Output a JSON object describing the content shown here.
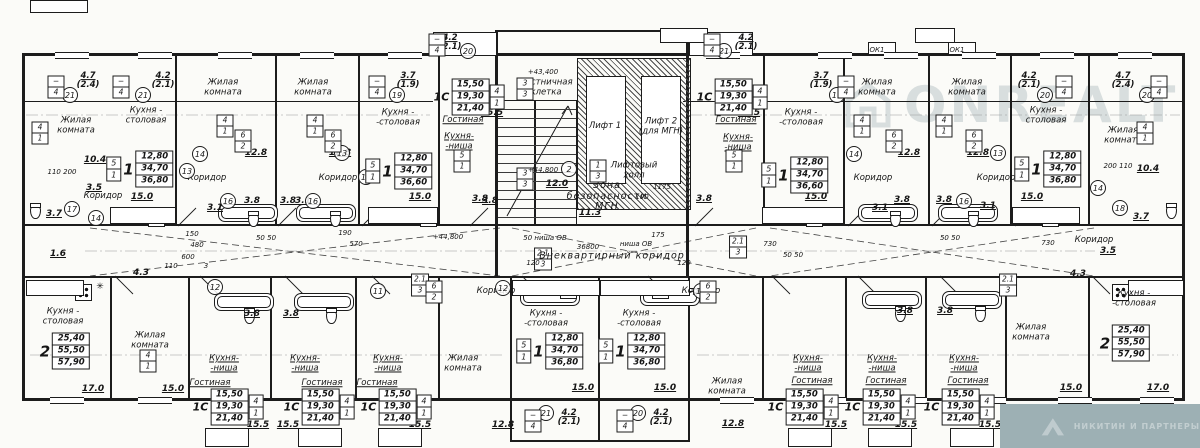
{
  "watermark": {
    "brand": "ONREALT",
    "agency": "НИКИТИН И ПАРТНЕРЫ"
  },
  "corridor": {
    "label": "Внеквартирный коридор",
    "length": "36800"
  },
  "core": {
    "stair": "Лестничная клетка",
    "stair_level": "+43,400",
    "landing_level": "+44,800",
    "lift1": "Лифт 1",
    "lift2": "Лифт 2 (для МГН)",
    "hall": "Лифтовый холл",
    "safety": "Зона безопасности МГН",
    "safety_area": "11.3",
    "landing_area": "12.0"
  },
  "labels": [
    [
      "Жилая\nкомната",
      76,
      126
    ],
    [
      "Кухня -\nстоловая",
      146,
      116
    ],
    [
      "Жилая\nкомната",
      223,
      88
    ],
    [
      "Жилая\nкомната",
      313,
      88
    ],
    [
      "Кухня -\n-столовая",
      398,
      118
    ],
    [
      "Гостиная",
      463,
      121,
      "u"
    ],
    [
      "Кухня-\n-ниша",
      459,
      142,
      "u"
    ],
    [
      "Лестничная\nклетка",
      546,
      88
    ],
    [
      "Лифт 1",
      605,
      127
    ],
    [
      "Лифт 2\n(для МГН)",
      661,
      127
    ],
    [
      "Лифтовый\nхолл",
      634,
      171
    ],
    [
      "Зона\nбезопасности\nМГН",
      607,
      197
    ],
    [
      "Гостиная",
      736,
      121,
      "u"
    ],
    [
      "Кухня-\n-ниша",
      738,
      143,
      "u"
    ],
    [
      "Кухня -\n-столовая",
      801,
      118
    ],
    [
      "Жилая\nкомната",
      877,
      88
    ],
    [
      "Жилая\nкомната",
      967,
      88
    ],
    [
      "Кухня -\nстоловая",
      1046,
      116
    ],
    [
      "Жилая\nкомната",
      1123,
      136
    ],
    [
      "Коридор",
      207,
      179
    ],
    [
      "Коридор",
      338,
      179
    ],
    [
      "Коридор",
      873,
      179
    ],
    [
      "Коридор",
      996,
      179
    ],
    [
      "Коридор",
      103,
      197
    ],
    [
      "Коридор",
      1094,
      241
    ],
    [
      "Кухня -\nстоловая",
      63,
      317
    ],
    [
      "Жилая\nкомната",
      150,
      341
    ],
    [
      "Кухня-\n-ниша",
      224,
      364,
      "u"
    ],
    [
      "Кухня-\n-ниша",
      305,
      364,
      "u"
    ],
    [
      "Кухня-\n-ниша",
      388,
      364,
      "u"
    ],
    [
      "Гостиная",
      210,
      384,
      "u"
    ],
    [
      "Гостиная",
      322,
      384,
      "u"
    ],
    [
      "Гостиная",
      377,
      384,
      "u"
    ],
    [
      "Жилая\nкомната",
      463,
      364
    ],
    [
      "Кухня -\n-столовая",
      546,
      319
    ],
    [
      "Кухня -\n-столовая",
      639,
      319
    ],
    [
      "Жилая\nкомната",
      727,
      387
    ],
    [
      "Кухня-\n-ниша",
      808,
      364,
      "u"
    ],
    [
      "Кухня-\n-ниша",
      882,
      364,
      "u"
    ],
    [
      "Кухня-\n-ниша",
      964,
      364,
      "u"
    ],
    [
      "Гостиная",
      812,
      382,
      "u"
    ],
    [
      "Гостиная",
      886,
      382,
      "u"
    ],
    [
      "Гостиная",
      968,
      382,
      "u"
    ],
    [
      "Жилая\nкомната",
      1031,
      333
    ],
    [
      "Кухня -\n-столовая",
      1134,
      299
    ],
    [
      "Коридор",
      496,
      292
    ],
    [
      "Коридор",
      701,
      292
    ]
  ],
  "areas": [
    [
      "10.4",
      95,
      160
    ],
    [
      "15.0",
      142,
      197
    ],
    [
      "12.8",
      256,
      153
    ],
    [
      "12.8",
      340,
      153
    ],
    [
      "15.0",
      420,
      197
    ],
    [
      "15.5",
      492,
      113
    ],
    [
      "3.8",
      480,
      199
    ],
    [
      "12.0",
      557,
      184
    ],
    [
      "11.3",
      590,
      213
    ],
    [
      "15.5",
      749,
      113
    ],
    [
      "3.8",
      704,
      199
    ],
    [
      "15.0",
      816,
      197
    ],
    [
      "12.8",
      909,
      153
    ],
    [
      "12.8",
      978,
      153
    ],
    [
      "15.0",
      1032,
      197
    ],
    [
      "10.4",
      1148,
      169
    ],
    [
      "3.7",
      1141,
      217
    ],
    [
      "3.7",
      54,
      214
    ],
    [
      "1.6",
      58,
      254
    ],
    [
      "3.5",
      94,
      188
    ],
    [
      "3.5",
      1108,
      251
    ],
    [
      "17.0",
      93,
      389
    ],
    [
      "15.0",
      173,
      389
    ],
    [
      "15.5",
      258,
      425
    ],
    [
      "15.5",
      288,
      425
    ],
    [
      "15.5",
      420,
      425
    ],
    [
      "12.8",
      503,
      425
    ],
    [
      "15.0",
      583,
      388
    ],
    [
      "15.0",
      665,
      388
    ],
    [
      "12.8",
      733,
      424
    ],
    [
      "15.5",
      836,
      425
    ],
    [
      "15.5",
      906,
      425
    ],
    [
      "15.5",
      990,
      425
    ],
    [
      "15.0",
      1071,
      388
    ],
    [
      "17.0",
      1158,
      388
    ],
    [
      "3.8",
      252,
      201
    ],
    [
      "3.8",
      288,
      201
    ],
    [
      "3.8",
      490,
      201
    ],
    [
      "3.8",
      902,
      200
    ],
    [
      "3.8",
      944,
      200
    ],
    [
      "3.8",
      252,
      314
    ],
    [
      "3.8",
      291,
      314
    ],
    [
      "3.8",
      905,
      311
    ],
    [
      "3.8",
      945,
      311
    ],
    [
      "3.1",
      215,
      208
    ],
    [
      "3.1",
      303,
      201
    ],
    [
      "3.1",
      880,
      208
    ],
    [
      "3.1",
      988,
      206
    ],
    [
      "4.3",
      141,
      273
    ],
    [
      "4.3",
      1078,
      274
    ]
  ],
  "balconies": [
    [
      "4.7",
      "(2.4)",
      88,
      81
    ],
    [
      "4.2",
      "(2.1)",
      163,
      81
    ],
    [
      "3.7",
      "(1.9)",
      408,
      81
    ],
    [
      "4.2",
      "(2.1)",
      450,
      43
    ],
    [
      "4.2",
      "(2.1)",
      746,
      43
    ],
    [
      "3.7",
      "(1.9)",
      821,
      81
    ],
    [
      "4.2",
      "(2.1)",
      1029,
      81
    ],
    [
      "4.7",
      "(2.4)",
      1123,
      81
    ],
    [
      "4.2",
      "(2.1)",
      569,
      418
    ],
    [
      "4.2",
      "(2.1)",
      661,
      418
    ]
  ],
  "circles": [
    [
      "21",
      70,
      95
    ],
    [
      "21",
      143,
      95
    ],
    [
      "19",
      397,
      95
    ],
    [
      "20",
      468,
      51
    ],
    [
      "21",
      724,
      51
    ],
    [
      "19",
      837,
      95
    ],
    [
      "20",
      1045,
      95
    ],
    [
      "20",
      1147,
      95
    ],
    [
      "17",
      72,
      209
    ],
    [
      "14",
      96,
      218
    ],
    [
      "13",
      187,
      171
    ],
    [
      "14",
      200,
      154
    ],
    [
      "16",
      228,
      201
    ],
    [
      "13",
      342,
      153
    ],
    [
      "14",
      366,
      177
    ],
    [
      "16",
      313,
      201
    ],
    [
      "2",
      569,
      169
    ],
    [
      "12",
      215,
      287
    ],
    [
      "12",
      503,
      288
    ],
    [
      "11",
      378,
      291
    ],
    [
      "11",
      701,
      291
    ],
    [
      "14",
      854,
      154
    ],
    [
      "13",
      998,
      153
    ],
    [
      "16",
      964,
      201
    ],
    [
      "14",
      1098,
      188
    ],
    [
      "18",
      1120,
      208
    ],
    [
      "21",
      546,
      413
    ],
    [
      "20",
      638,
      413
    ]
  ],
  "tags": [
    [
      "−",
      "4",
      56,
      87
    ],
    [
      "−",
      "4",
      121,
      87
    ],
    [
      "−",
      "4",
      377,
      87
    ],
    [
      "−",
      "4",
      437,
      45
    ],
    [
      "−",
      "4",
      712,
      45
    ],
    [
      "−",
      "4",
      846,
      87
    ],
    [
      "−",
      "4",
      1064,
      87
    ],
    [
      "−",
      "4",
      1159,
      87
    ],
    [
      "4",
      "1",
      40,
      133
    ],
    [
      "4",
      "1",
      225,
      126
    ],
    [
      "4",
      "1",
      315,
      126
    ],
    [
      "5",
      "1",
      462,
      161
    ],
    [
      "5",
      "1",
      734,
      161
    ],
    [
      "4",
      "1",
      862,
      126
    ],
    [
      "4",
      "1",
      944,
      126
    ],
    [
      "4",
      "1",
      1145,
      133
    ],
    [
      "6",
      "2",
      243,
      141
    ],
    [
      "6",
      "2",
      333,
      141
    ],
    [
      "6",
      "2",
      894,
      141
    ],
    [
      "6",
      "2",
      974,
      141
    ],
    [
      "3",
      "3",
      525,
      89
    ],
    [
      "3",
      "3",
      525,
      179
    ],
    [
      "1",
      "3",
      598,
      171
    ],
    [
      "2.1",
      "3",
      420,
      285
    ],
    [
      "2.1",
      "3",
      543,
      259
    ],
    [
      "2.1",
      "3",
      738,
      247
    ],
    [
      "2.1",
      "3",
      1008,
      285
    ],
    [
      "−",
      "4",
      533,
      421
    ],
    [
      "−",
      "4",
      625,
      421
    ],
    [
      "4",
      "1",
      148,
      361
    ],
    [
      "6",
      "2",
      434,
      292
    ],
    [
      "6",
      "2",
      708,
      292
    ]
  ],
  "stamps": [
    [
      "1",
      "12,80",
      "34,70",
      "36,80",
      140,
      169,
      1,
      0
    ],
    [
      "1",
      "12,80",
      "34,70",
      "36,60",
      399,
      171,
      1,
      0
    ],
    [
      "1С",
      "15,50",
      "19,30",
      "21,40",
      468,
      97,
      0,
      1
    ],
    [
      "1С",
      "15,50",
      "19,30",
      "21,40",
      731,
      97,
      0,
      1
    ],
    [
      "1",
      "12,80",
      "34,70",
      "36,60",
      795,
      175,
      1,
      0
    ],
    [
      "1",
      "12,80",
      "34,70",
      "36,80",
      1048,
      169,
      1,
      0
    ],
    [
      "2",
      "25,40",
      "55,50",
      "57,90",
      64,
      351,
      0,
      0
    ],
    [
      "2",
      "25,40",
      "55,50",
      "57,90",
      1124,
      343,
      0,
      0
    ],
    [
      "1С",
      "15,50",
      "19,30",
      "21,40",
      227,
      407,
      0,
      1
    ],
    [
      "1С",
      "15,50",
      "19,30",
      "21,40",
      318,
      407,
      0,
      1
    ],
    [
      "1С",
      "15,50",
      "19,30",
      "21,40",
      395,
      407,
      0,
      1
    ],
    [
      "1",
      "12,80",
      "34,70",
      "36,80",
      550,
      351,
      1,
      0
    ],
    [
      "1",
      "12,80",
      "34,70",
      "36,80",
      632,
      351,
      1,
      0
    ],
    [
      "1С",
      "15,50",
      "19,30",
      "21,40",
      802,
      407,
      0,
      1
    ],
    [
      "1С",
      "15,50",
      "19,30",
      "21,40",
      879,
      407,
      0,
      1
    ],
    [
      "1С",
      "15,50",
      "19,30",
      "21,40",
      958,
      407,
      0,
      1
    ]
  ],
  "dims": [
    [
      "110 200",
      62,
      172
    ],
    [
      "200 110",
      1118,
      166
    ],
    [
      "+43,400",
      543,
      72
    ],
    [
      "+44,800",
      543,
      170
    ],
    [
      "+44,800",
      448,
      237
    ],
    [
      "36800",
      588,
      247
    ],
    [
      "50 ниша ОВ",
      545,
      238
    ],
    [
      "ниша ОВ",
      636,
      244
    ],
    [
      "1175",
      662,
      187
    ],
    [
      "100",
      642,
      197
    ],
    [
      "175",
      658,
      235
    ],
    [
      "120",
      533,
      263
    ],
    [
      "120",
      684,
      263
    ],
    [
      "730",
      770,
      244
    ],
    [
      "730",
      1048,
      243
    ],
    [
      "570",
      356,
      244
    ],
    [
      "190",
      345,
      233
    ],
    [
      "480",
      197,
      245
    ],
    [
      "600",
      188,
      257
    ],
    [
      "110",
      171,
      266
    ],
    [
      "150",
      192,
      234
    ],
    [
      "50  50",
      266,
      238
    ],
    [
      "50  50",
      793,
      255
    ],
    [
      "50  50",
      950,
      238
    ],
    [
      "ОК1",
      877,
      50
    ],
    [
      "ОК1",
      957,
      50
    ],
    [
      "ОК2",
      1037,
      409
    ],
    [
      "3",
      206,
      266
    ]
  ]
}
